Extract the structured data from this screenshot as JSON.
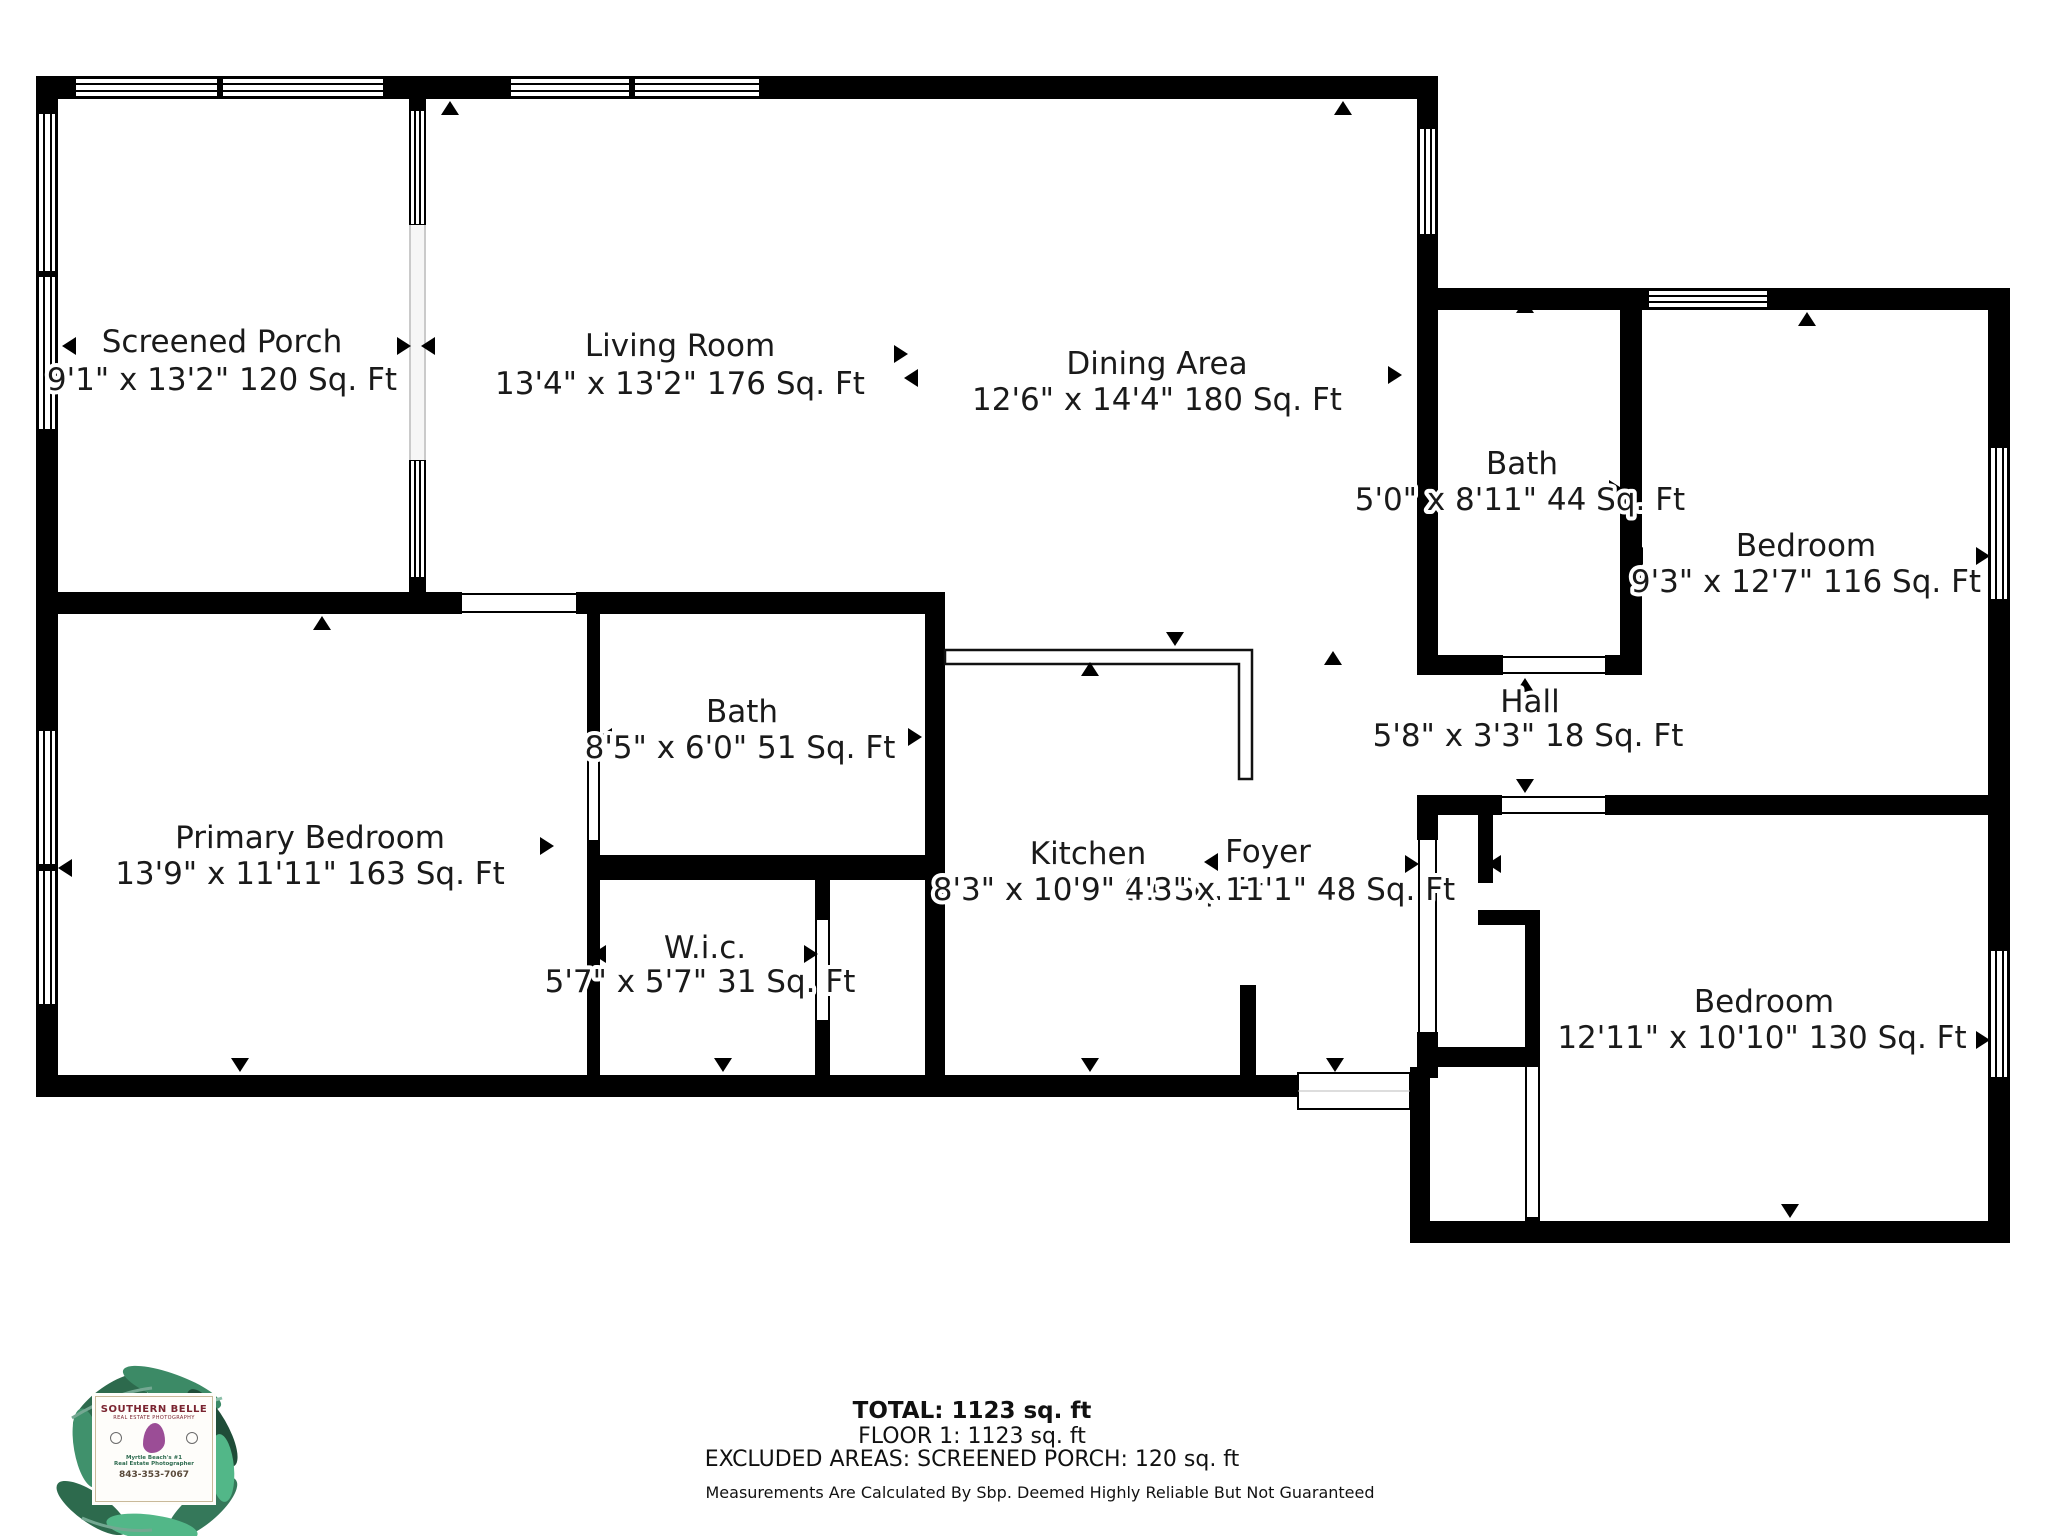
{
  "rooms": [
    {
      "id": "screened-porch",
      "name": "Screened Porch",
      "dims": "9'1\" x 13'2\" 120 Sq. Ft"
    },
    {
      "id": "living-room",
      "name": "Living Room",
      "dims": "13'4\" x 13'2\" 176 Sq. Ft"
    },
    {
      "id": "dining-area",
      "name": "Dining Area",
      "dims": "12'6\" x 14'4\" 180 Sq. Ft"
    },
    {
      "id": "bath-upper",
      "name": "Bath",
      "dims": "5'0\" x 8'11\" 44 Sq. Ft"
    },
    {
      "id": "bedroom-right",
      "name": "Bedroom",
      "dims": "9'3\" x 12'7\" 116 Sq. Ft"
    },
    {
      "id": "hall",
      "name": "Hall",
      "dims": "5'8\" x 3'3\" 18 Sq. Ft"
    },
    {
      "id": "primary-bedroom",
      "name": "Primary Bedroom",
      "dims": "13'9\" x 11'11\" 163 Sq. Ft"
    },
    {
      "id": "bath-main",
      "name": "Bath",
      "dims": "8'5\" x 6'0\" 51 Sq. Ft"
    },
    {
      "id": "wic",
      "name": "W.i.c.",
      "dims": "5'7\" x 5'7\" 31 Sq. Ft"
    },
    {
      "id": "kitchen",
      "name": "Kitchen",
      "dims": "8'3\" x 10'9\" 91 Sq. Ft"
    },
    {
      "id": "foyer",
      "name": "Foyer",
      "dims": "4'3\" x 11'1\" 48 Sq. Ft"
    },
    {
      "id": "bedroom-lower",
      "name": "Bedroom",
      "dims": "12'11\" x 10'10\" 130 Sq. Ft"
    }
  ],
  "summary": {
    "total": "TOTAL: 1123 sq. ft",
    "floor": "FLOOR 1: 1123 sq. ft",
    "excluded": "EXCLUDED AREAS: SCREENED PORCH: 120 sq. ft",
    "disclaimer": "Measurements Are Calculated By Sbp. Deemed Highly Reliable But Not Guaranteed"
  },
  "logo": {
    "line1": "SOUTHERN BELLE",
    "line2": "REAL ESTATE PHOTOGRAPHY",
    "line3": "Myrtle Beach's #1",
    "line4": "Real Estate Photographer",
    "phone": "843-353-7067"
  },
  "colors": {
    "wall": "#000000",
    "paper": "#ffffff",
    "label": "#1a1a1a",
    "logo_green": "#2d6a4f",
    "logo_maroon": "#7a2430",
    "logo_purple": "#9b4d96"
  }
}
